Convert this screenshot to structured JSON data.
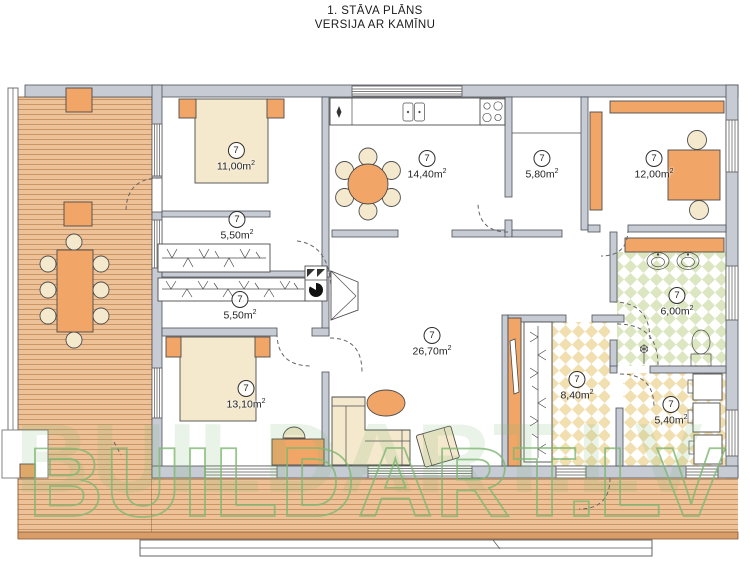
{
  "title": {
    "line1": "1. STĀVA PLĀNS",
    "line2": "VERSIJA AR KAMĪNU"
  },
  "watermark": {
    "text": "BUILDART.LV"
  },
  "rooms": [
    {
      "name": "bedroom-1",
      "number": "7",
      "area": "11,00",
      "unit": "m",
      "sup": "2"
    },
    {
      "name": "closet-1",
      "number": "7",
      "area": "5,50",
      "unit": "m",
      "sup": "2"
    },
    {
      "name": "closet-2",
      "number": "7",
      "area": "5,50",
      "unit": "m",
      "sup": "2"
    },
    {
      "name": "kitchen-dining",
      "number": "7",
      "area": "14,40",
      "unit": "m",
      "sup": "2"
    },
    {
      "name": "pantry",
      "number": "7",
      "area": "5,80",
      "unit": "m",
      "sup": "2"
    },
    {
      "name": "office",
      "number": "7",
      "area": "12,00",
      "unit": "m",
      "sup": "2"
    },
    {
      "name": "bathroom",
      "number": "7",
      "area": "6,00",
      "unit": "m",
      "sup": "2"
    },
    {
      "name": "living-room",
      "number": "7",
      "area": "26,70",
      "unit": "m",
      "sup": "2"
    },
    {
      "name": "hallway",
      "number": "7",
      "area": "8,40",
      "unit": "m",
      "sup": "2"
    },
    {
      "name": "bedroom-2",
      "number": "7",
      "area": "13,10",
      "unit": "m",
      "sup": "2"
    },
    {
      "name": "laundry",
      "number": "7",
      "area": "5,40",
      "unit": "m",
      "sup": "2"
    }
  ],
  "colors": {
    "wall": "#c7cbd4",
    "deck": "#edc298",
    "deck_line": "#c88f5d",
    "orange": "#f1a566",
    "beige": "#f5e9cd",
    "tile_green": "#dce7c1",
    "tile_tan": "#f2dfb0",
    "watermark": "#7fb873"
  }
}
